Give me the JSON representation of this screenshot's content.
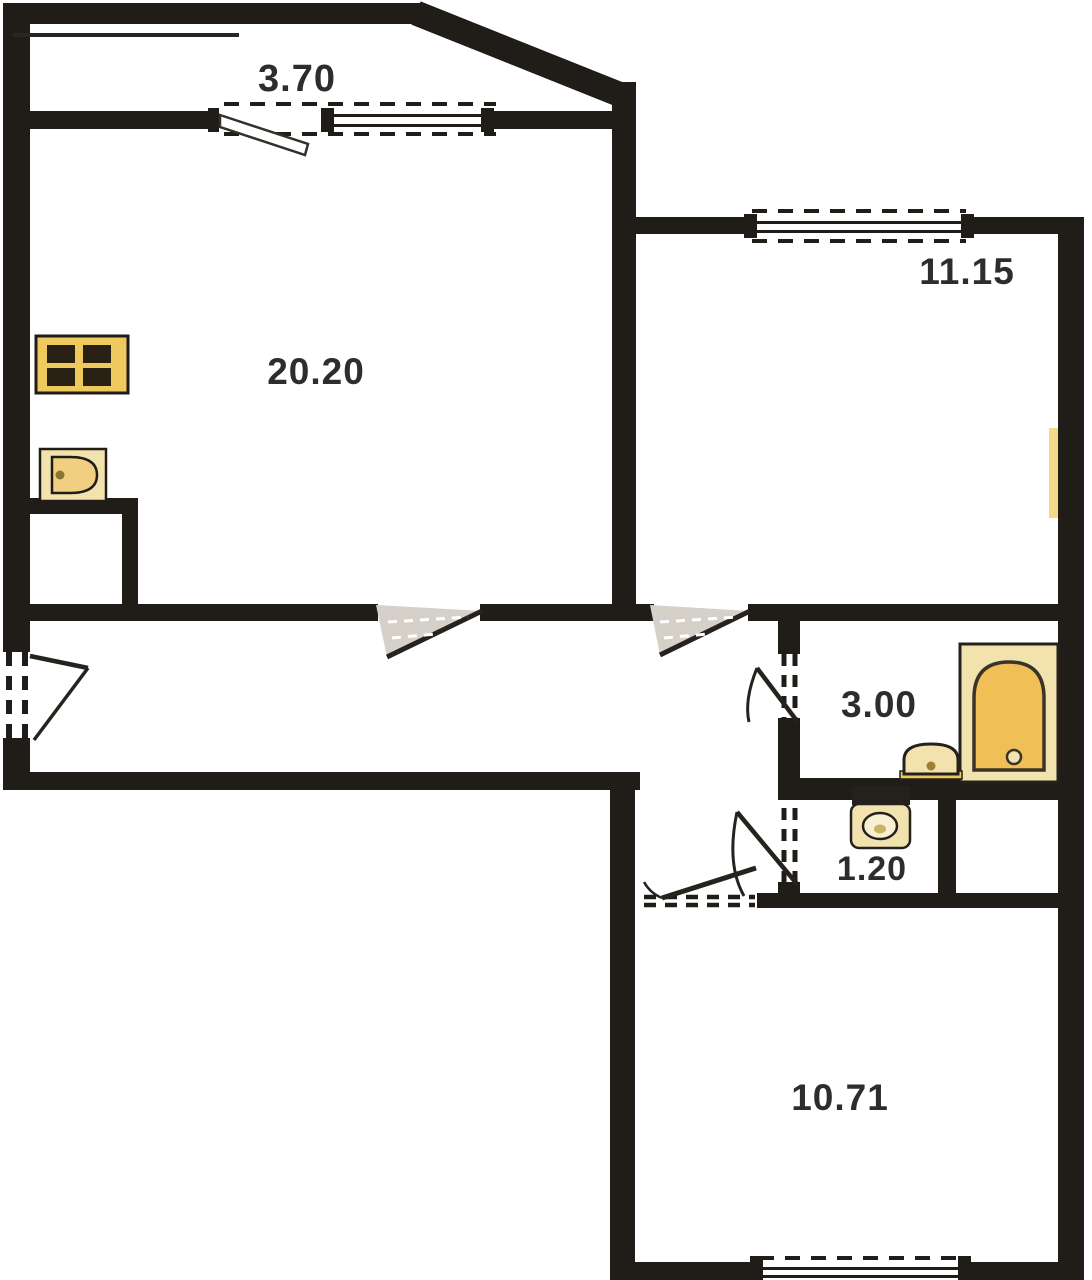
{
  "rooms": {
    "balcony": {
      "label": "3.70"
    },
    "living_room": {
      "label": "20.20"
    },
    "bedroom_top": {
      "label": "11.15"
    },
    "bathroom": {
      "label": "3.00"
    },
    "wc": {
      "label": "1.20"
    },
    "bedroom_bottom": {
      "label": "10.71"
    }
  },
  "fixtures": {
    "stove": "stove-icon",
    "kitchen_sink": "kitchen-sink-icon",
    "bathtub": "bathtub-icon",
    "washbasin": "washbasin-icon",
    "toilet": "toilet-icon",
    "radiator": "radiator-icon"
  },
  "colors": {
    "wall": "#201c18",
    "background": "#ffffff",
    "fixture_gold": "#eec95e",
    "fixture_gold_light": "#f2e3ae",
    "fixture_gold_deep": "#f0bf55",
    "door_swing_gray": "#d6d1c8",
    "label_text": "#2d2d2d"
  }
}
